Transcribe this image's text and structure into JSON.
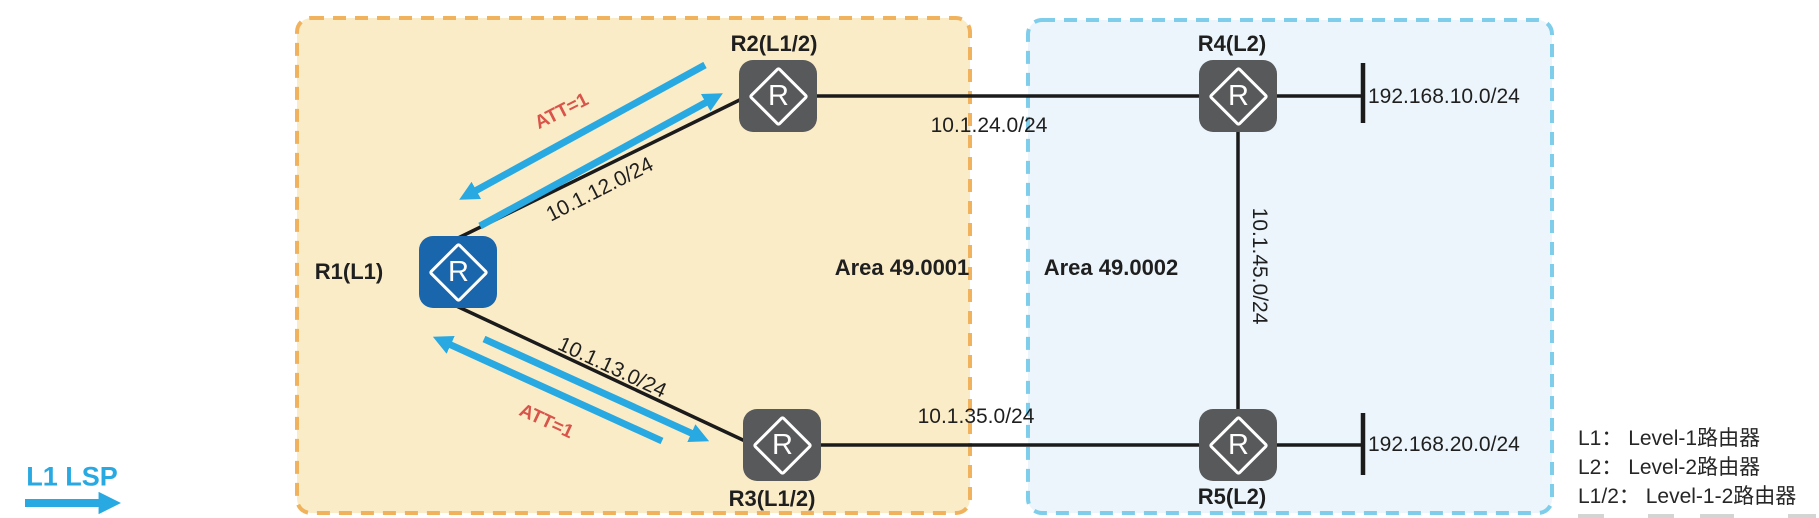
{
  "router_icon_letter": "R",
  "areas": {
    "a1": {
      "label": "Area 49.0001"
    },
    "a2": {
      "label": "Area 49.0002"
    }
  },
  "nodes": {
    "r1": {
      "label": "R1(L1)"
    },
    "r2": {
      "label": "R2(L1/2)"
    },
    "r3": {
      "label": "R3(L1/2)"
    },
    "r4": {
      "label": "R4(L2)"
    },
    "r5": {
      "label": "R5(L2)"
    }
  },
  "links": {
    "r1r2": {
      "label": "10.1.12.0/24",
      "att": "ATT=1"
    },
    "r1r3": {
      "label": "10.1.13.0/24",
      "att": "ATT=1"
    },
    "r2r4": {
      "label": "10.1.24.0/24"
    },
    "r3r5": {
      "label": "10.1.35.0/24"
    },
    "r4r5": {
      "label": "10.1.45.0/24"
    }
  },
  "stubs": {
    "r4": {
      "label": "192.168.10.0/24"
    },
    "r5": {
      "label": "192.168.20.0/24"
    }
  },
  "legend": {
    "lsp_label": "L1 LSP",
    "items": [
      {
        "label": "L1： Level-1路由器"
      },
      {
        "label": "L2： Level-2路由器"
      },
      {
        "label": "L1/2： Level-1-2路由器"
      }
    ]
  },
  "colors": {
    "area1_fill": "#fbecc8",
    "area1_border": "#f0b25c",
    "area2_fill": "#ebf5fb",
    "area2_border": "#7ecdea",
    "router_l1_fill": "#1a66ad",
    "router_l2_fill": "#58595b",
    "link_line": "#1b1b1b",
    "lsp_arrow": "#29a9e1",
    "att_text": "#d9544a"
  }
}
